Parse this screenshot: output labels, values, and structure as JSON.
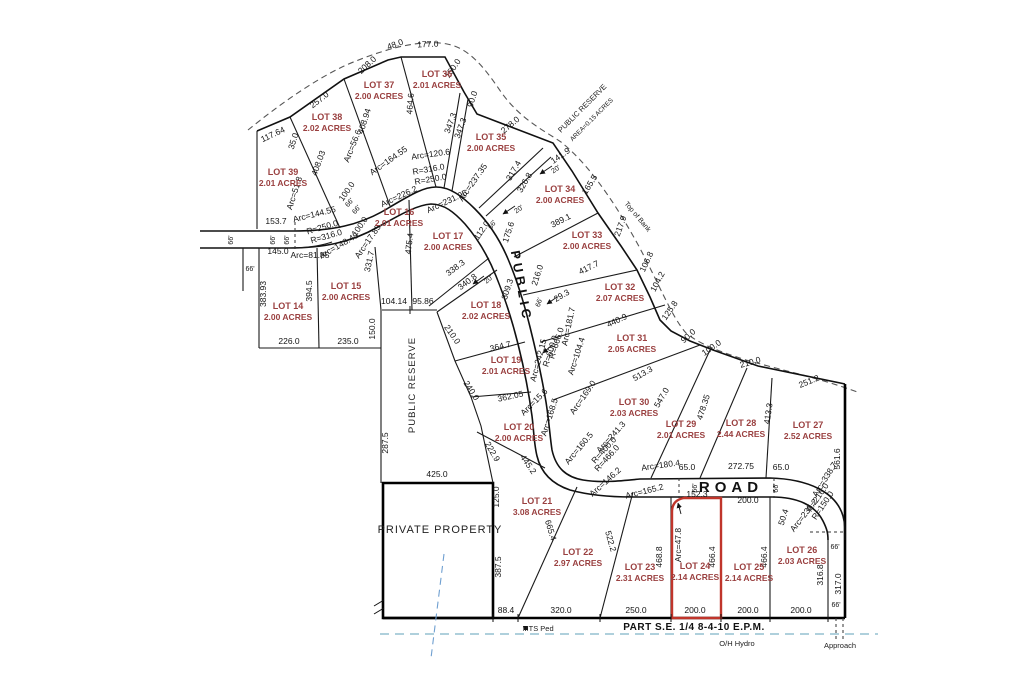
{
  "colors": {
    "lot_text": "#9a4040",
    "dim_text": "#141414",
    "red_outline": "#c0352b",
    "hydro_line": "#7fb4c8",
    "bank_dash": "#555555"
  },
  "map": {
    "road_names": {
      "vertical": "PUBLIC",
      "horizontal": "ROAD"
    },
    "lots": [
      {
        "n": "LOT 39",
        "a": "2.01 ACRES",
        "x": 283,
        "y": 175
      },
      {
        "n": "LOT 38",
        "a": "2.02 ACRES",
        "x": 327,
        "y": 120
      },
      {
        "n": "LOT 37",
        "a": "2.00 ACRES",
        "x": 379,
        "y": 88
      },
      {
        "n": "LOT 36",
        "a": "2.01 ACRES",
        "x": 437,
        "y": 77
      },
      {
        "n": "LOT 35",
        "a": "2.00 ACRES",
        "x": 491,
        "y": 140
      },
      {
        "n": "LOT 34",
        "a": "2.00 ACRES",
        "x": 560,
        "y": 192
      },
      {
        "n": "LOT 33",
        "a": "2.00 ACRES",
        "x": 587,
        "y": 238
      },
      {
        "n": "LOT 32",
        "a": "2.07 ACRES",
        "x": 620,
        "y": 290
      },
      {
        "n": "LOT 31",
        "a": "2.05 ACRES",
        "x": 632,
        "y": 341
      },
      {
        "n": "LOT 30",
        "a": "2.03 ACRES",
        "x": 634,
        "y": 405
      },
      {
        "n": "LOT 29",
        "a": "2.01 ACRES",
        "x": 681,
        "y": 427
      },
      {
        "n": "LOT 28",
        "a": "2.44 ACRES",
        "x": 741,
        "y": 426
      },
      {
        "n": "LOT 27",
        "a": "2.52 ACRES",
        "x": 808,
        "y": 428
      },
      {
        "n": "LOT 26",
        "a": "2.03 ACRES",
        "x": 802,
        "y": 553
      },
      {
        "n": "LOT 25",
        "a": "2.14 ACRES",
        "x": 749,
        "y": 570
      },
      {
        "n": "LOT 24",
        "a": "2.14 ACRES",
        "x": 695,
        "y": 569
      },
      {
        "n": "LOT 23",
        "a": "2.31 ACRES",
        "x": 640,
        "y": 570
      },
      {
        "n": "LOT 22",
        "a": "2.97 ACRES",
        "x": 578,
        "y": 555
      },
      {
        "n": "LOT 21",
        "a": "3.08 ACRES",
        "x": 537,
        "y": 504
      },
      {
        "n": "LOT 20",
        "a": "2.00 ACRES",
        "x": 519,
        "y": 430
      },
      {
        "n": "LOT 19",
        "a": "2.01 ACRES",
        "x": 506,
        "y": 363
      },
      {
        "n": "LOT 18",
        "a": "2.02 ACRES",
        "x": 486,
        "y": 308
      },
      {
        "n": "LOT 17",
        "a": "2.00 ACRES",
        "x": 448,
        "y": 239
      },
      {
        "n": "LOT 16",
        "a": "2.01 ACRES",
        "x": 399,
        "y": 215
      },
      {
        "n": "LOT 15",
        "a": "2.00 ACRES",
        "x": 346,
        "y": 289
      },
      {
        "n": "LOT 14",
        "a": "2.00 ACRES",
        "x": 288,
        "y": 309
      }
    ],
    "labels": [
      {
        "t": "117.64",
        "x": 274,
        "y": 137,
        "r": -25
      },
      {
        "t": "257.0",
        "x": 321,
        "y": 102,
        "r": -38
      },
      {
        "t": "208.0",
        "x": 369,
        "y": 67,
        "r": -43
      },
      {
        "t": "48.0",
        "x": 396,
        "y": 47,
        "r": -20
      },
      {
        "t": "177.0",
        "x": 428,
        "y": 47,
        "r": -3
      },
      {
        "t": "150.0",
        "x": 455,
        "y": 70,
        "r": -55
      },
      {
        "t": "90.0",
        "x": 475,
        "y": 100,
        "r": -72
      },
      {
        "t": "278.0",
        "x": 512,
        "y": 127,
        "r": -40
      },
      {
        "t": "141.9",
        "x": 562,
        "y": 158,
        "r": -35
      },
      {
        "t": "165.5",
        "x": 592,
        "y": 186,
        "r": -58
      },
      {
        "t": "217.9",
        "x": 623,
        "y": 227,
        "r": -70
      },
      {
        "t": "106.8",
        "x": 649,
        "y": 263,
        "r": -65
      },
      {
        "t": "104.2",
        "x": 660,
        "y": 283,
        "r": -62
      },
      {
        "t": "125.8",
        "x": 672,
        "y": 312,
        "r": -55
      },
      {
        "t": "90.0",
        "x": 690,
        "y": 338,
        "r": -42
      },
      {
        "t": "100.0",
        "x": 713,
        "y": 350,
        "r": -35
      },
      {
        "t": "210.0",
        "x": 751,
        "y": 365,
        "r": -16
      },
      {
        "t": "251.2",
        "x": 810,
        "y": 384,
        "r": -22
      },
      {
        "t": "561.6",
        "x": 840,
        "y": 459,
        "r": -90
      },
      {
        "t": "35.0",
        "x": 296,
        "y": 142,
        "r": -72
      },
      {
        "t": "408.03",
        "x": 321,
        "y": 164,
        "r": -70
      },
      {
        "t": "Arc=56.6",
        "x": 355,
        "y": 147,
        "r": -68
      },
      {
        "t": "408.94",
        "x": 367,
        "y": 122,
        "r": -72
      },
      {
        "t": "464.6",
        "x": 413,
        "y": 104,
        "r": -85
      },
      {
        "t": "347.3",
        "x": 453,
        "y": 124,
        "r": -70
      },
      {
        "t": "347.3",
        "x": 463,
        "y": 129,
        "r": -70
      },
      {
        "t": "Arc=51.8",
        "x": 297,
        "y": 194,
        "r": -72
      },
      {
        "t": "100.0",
        "x": 349,
        "y": 193,
        "r": -55
      },
      {
        "t": "66'",
        "x": 351,
        "y": 204,
        "r": -50,
        "s": 7
      },
      {
        "t": "66'",
        "x": 358,
        "y": 211,
        "r": -50,
        "s": 7
      },
      {
        "t": "Arc=164.55",
        "x": 390,
        "y": 163,
        "r": -35
      },
      {
        "t": "Arc=120.6",
        "x": 431,
        "y": 157,
        "r": -8
      },
      {
        "t": "R=316.0",
        "x": 429,
        "y": 172,
        "r": -10
      },
      {
        "t": "R=250.0",
        "x": 431,
        "y": 182,
        "r": -10
      },
      {
        "t": "Arc=237.35",
        "x": 475,
        "y": 184,
        "r": -55
      },
      {
        "t": "317.4",
        "x": 516,
        "y": 172,
        "r": -60
      },
      {
        "t": "326.8",
        "x": 527,
        "y": 184,
        "r": -60
      },
      {
        "t": "20'",
        "x": 557,
        "y": 171,
        "r": -35,
        "s": 7
      },
      {
        "t": "20'",
        "x": 520,
        "y": 211,
        "r": -35,
        "s": 7
      },
      {
        "t": "20'",
        "x": 490,
        "y": 281,
        "r": -40,
        "s": 7
      },
      {
        "t": "389.1",
        "x": 562,
        "y": 223,
        "r": -27
      },
      {
        "t": "417.7",
        "x": 590,
        "y": 270,
        "r": -26
      },
      {
        "t": "440.9",
        "x": 618,
        "y": 323,
        "r": -25
      },
      {
        "t": "513.3",
        "x": 644,
        "y": 376,
        "r": -30
      },
      {
        "t": "547.0",
        "x": 664,
        "y": 399,
        "r": -60
      },
      {
        "t": "478.35",
        "x": 706,
        "y": 408,
        "r": -72
      },
      {
        "t": "413.3",
        "x": 771,
        "y": 414,
        "r": -82
      },
      {
        "t": "216.0",
        "x": 540,
        "y": 276,
        "r": -72
      },
      {
        "t": "66'",
        "x": 541,
        "y": 303,
        "r": -72,
        "s": 7
      },
      {
        "t": "29.3",
        "x": 563,
        "y": 298,
        "r": -30
      },
      {
        "t": "Arc=181.7",
        "x": 571,
        "y": 327,
        "r": -78
      },
      {
        "t": "Arc=242.15",
        "x": 541,
        "y": 361,
        "r": -75
      },
      {
        "t": "R=666.0",
        "x": 559,
        "y": 344,
        "r": -72
      },
      {
        "t": "R=600.0",
        "x": 553,
        "y": 352,
        "r": -72
      },
      {
        "t": "Arc=104.4",
        "x": 579,
        "y": 357,
        "r": -72
      },
      {
        "t": "Arc=169.0",
        "x": 585,
        "y": 399,
        "r": -55
      },
      {
        "t": "Arc=241.3",
        "x": 613,
        "y": 439,
        "r": -48
      },
      {
        "t": "Arc=160.5",
        "x": 581,
        "y": 450,
        "r": -50
      },
      {
        "t": "R=400.0",
        "x": 606,
        "y": 452,
        "r": -48
      },
      {
        "t": "R=466.0",
        "x": 609,
        "y": 460,
        "r": -48
      },
      {
        "t": "Arc=146.2",
        "x": 607,
        "y": 484,
        "r": -42
      },
      {
        "t": "Arc=165.2",
        "x": 645,
        "y": 494,
        "r": -14
      },
      {
        "t": "Arc=180.4",
        "x": 661,
        "y": 468,
        "r": -8
      },
      {
        "t": "65.0",
        "x": 687,
        "y": 470,
        "r": 0
      },
      {
        "t": "272.75",
        "x": 741,
        "y": 469,
        "r": 0
      },
      {
        "t": "65.0",
        "x": 781,
        "y": 470,
        "r": 0
      },
      {
        "t": "66'",
        "x": 697,
        "y": 488,
        "r": -90,
        "s": 7
      },
      {
        "t": "66'",
        "x": 778,
        "y": 488,
        "r": -90,
        "s": 7
      },
      {
        "t": "Arc=338.7",
        "x": 827,
        "y": 481,
        "r": -58
      },
      {
        "t": "R=216.0",
        "x": 820,
        "y": 499,
        "r": -56
      },
      {
        "t": "R=150.0",
        "x": 825,
        "y": 507,
        "r": -56
      },
      {
        "t": "Arc=235.2",
        "x": 806,
        "y": 517,
        "r": -52
      },
      {
        "t": "50.4",
        "x": 786,
        "y": 518,
        "r": -72
      },
      {
        "t": "66'",
        "x": 835,
        "y": 549,
        "r": 0,
        "s": 7
      },
      {
        "t": "316.8",
        "x": 823,
        "y": 575,
        "r": -90
      },
      {
        "t": "317.0",
        "x": 841,
        "y": 584,
        "r": -90
      },
      {
        "t": "66'",
        "x": 836,
        "y": 607,
        "r": 0,
        "s": 7
      },
      {
        "t": "153.7",
        "x": 276,
        "y": 224,
        "r": 0
      },
      {
        "t": "66'",
        "x": 233,
        "y": 240,
        "r": -90,
        "s": 7
      },
      {
        "t": "66'",
        "x": 275,
        "y": 240,
        "r": -90,
        "s": 7
      },
      {
        "t": "66'",
        "x": 289,
        "y": 240,
        "r": -90,
        "s": 7
      },
      {
        "t": "66'",
        "x": 250,
        "y": 271,
        "r": 0,
        "s": 7
      },
      {
        "t": "145.0",
        "x": 278,
        "y": 254,
        "r": 0
      },
      {
        "t": "Arc=81.85",
        "x": 310,
        "y": 258,
        "r": 0
      },
      {
        "t": "Arc=144.55",
        "x": 315,
        "y": 217,
        "r": -14
      },
      {
        "t": "R=250.0",
        "x": 323,
        "y": 230,
        "r": -16
      },
      {
        "t": "R=316.0",
        "x": 327,
        "y": 239,
        "r": -16
      },
      {
        "t": "Arc=148.45",
        "x": 340,
        "y": 248,
        "r": -30
      },
      {
        "t": "100.0",
        "x": 362,
        "y": 228,
        "r": -55
      },
      {
        "t": "Arc=17.85",
        "x": 370,
        "y": 243,
        "r": -55
      },
      {
        "t": "331.7",
        "x": 372,
        "y": 262,
        "r": -78
      },
      {
        "t": "475.4",
        "x": 412,
        "y": 244,
        "r": -83
      },
      {
        "t": "Arc=226.2",
        "x": 400,
        "y": 199,
        "r": -25
      },
      {
        "t": "Arc=231.95",
        "x": 448,
        "y": 204,
        "r": -25
      },
      {
        "t": "112.0",
        "x": 484,
        "y": 232,
        "r": -55
      },
      {
        "t": "66'",
        "x": 494,
        "y": 226,
        "r": -55,
        "s": 7
      },
      {
        "t": "175.6",
        "x": 511,
        "y": 233,
        "r": -72
      },
      {
        "t": "338.3",
        "x": 457,
        "y": 270,
        "r": -37
      },
      {
        "t": "340.8",
        "x": 469,
        "y": 284,
        "r": -37
      },
      {
        "t": "309.3",
        "x": 510,
        "y": 290,
        "r": -72
      },
      {
        "t": "383.93",
        "x": 266,
        "y": 294,
        "r": -90
      },
      {
        "t": "394.5",
        "x": 312,
        "y": 291,
        "r": -90
      },
      {
        "t": "226.0",
        "x": 289,
        "y": 344,
        "r": 0
      },
      {
        "t": "235.0",
        "x": 348,
        "y": 344,
        "r": 0
      },
      {
        "t": "104.14",
        "x": 394,
        "y": 304,
        "r": 0
      },
      {
        "t": "95.86",
        "x": 423,
        "y": 304,
        "r": 0
      },
      {
        "t": "150.0",
        "x": 375,
        "y": 329,
        "r": -90
      },
      {
        "t": "287.5",
        "x": 388,
        "y": 443,
        "r": -90
      },
      {
        "t": "425.0",
        "x": 437,
        "y": 477,
        "r": 0
      },
      {
        "t": "210.0",
        "x": 450,
        "y": 336,
        "r": 55
      },
      {
        "t": "240.0",
        "x": 469,
        "y": 392,
        "r": 57
      },
      {
        "t": "222.9",
        "x": 490,
        "y": 453,
        "r": 60
      },
      {
        "t": "125.0",
        "x": 499,
        "y": 497,
        "r": -90
      },
      {
        "t": "364.7",
        "x": 501,
        "y": 349,
        "r": -14
      },
      {
        "t": "362.05",
        "x": 511,
        "y": 399,
        "r": -12
      },
      {
        "t": "Arc=15.6",
        "x": 536,
        "y": 404,
        "r": -45
      },
      {
        "t": "Arc=168.5",
        "x": 552,
        "y": 418,
        "r": -72
      },
      {
        "t": "445.2",
        "x": 526,
        "y": 466,
        "r": 55
      },
      {
        "t": "665.4",
        "x": 548,
        "y": 531,
        "r": 73
      },
      {
        "t": "522.2",
        "x": 608,
        "y": 542,
        "r": 74
      },
      {
        "t": "387.5",
        "x": 501,
        "y": 567,
        "r": -90
      },
      {
        "t": "88.4",
        "x": 506,
        "y": 613,
        "r": 0
      },
      {
        "t": "320.0",
        "x": 561,
        "y": 613,
        "r": 0
      },
      {
        "t": "250.0",
        "x": 636,
        "y": 613,
        "r": 0
      },
      {
        "t": "200.0",
        "x": 695,
        "y": 613,
        "r": 0
      },
      {
        "t": "200.0",
        "x": 748,
        "y": 613,
        "r": 0
      },
      {
        "t": "200.0",
        "x": 801,
        "y": 613,
        "r": 0
      },
      {
        "t": "468.8",
        "x": 662,
        "y": 557,
        "r": -90
      },
      {
        "t": "Arc=47.8",
        "x": 681,
        "y": 545,
        "r": -90
      },
      {
        "t": "152.3",
        "x": 697,
        "y": 497,
        "r": 0
      },
      {
        "t": "466.4",
        "x": 715,
        "y": 557,
        "r": -90
      },
      {
        "t": "466.4",
        "x": 767,
        "y": 557,
        "r": -90
      },
      {
        "t": "200.0",
        "x": 748,
        "y": 503,
        "r": 0
      },
      {
        "t": "Top  of  Bank",
        "x": 636,
        "y": 218,
        "r": 50,
        "s": 7,
        "c": "note"
      },
      {
        "t": "PUBLIC  RESERVE",
        "x": 584,
        "y": 110,
        "r": -45,
        "s": 7.5,
        "c": "note"
      },
      {
        "t": "AREA=0.15  ACRES",
        "x": 593,
        "y": 121,
        "r": -45,
        "s": 6.5,
        "c": "note"
      },
      {
        "t": "PUBLIC  RESERVE",
        "x": 415,
        "y": 385,
        "r": -90,
        "s": 9.5,
        "c": "note",
        "ls": 1
      },
      {
        "t": "PRIVATE  PROPERTY",
        "x": 440,
        "y": 533,
        "r": 0,
        "s": 11,
        "c": "note",
        "ls": 1
      },
      {
        "t": "MTS  Ped",
        "x": 538,
        "y": 631,
        "r": 0,
        "s": 7.5,
        "c": "note"
      },
      {
        "t": "PART  S.E.  1/4  8-4-10  E.P.M.",
        "x": 694,
        "y": 630,
        "r": 0,
        "s": 10,
        "c": "road",
        "ls": 0.5
      },
      {
        "t": "O/H  Hydro",
        "x": 737,
        "y": 646,
        "r": 0,
        "s": 7.5,
        "c": "note"
      },
      {
        "t": "Approach",
        "x": 840,
        "y": 648,
        "r": 0,
        "s": 7.5,
        "c": "note"
      },
      {
        "t": "PUBLIC",
        "x": 517,
        "y": 287,
        "r": 80,
        "s": 13,
        "c": "road",
        "ls": 4,
        "n": "road-name-public"
      },
      {
        "t": "ROAD",
        "x": 731,
        "y": 492,
        "r": 0,
        "s": 15,
        "c": "road",
        "ls": 5,
        "n": "road-name-road"
      }
    ]
  }
}
